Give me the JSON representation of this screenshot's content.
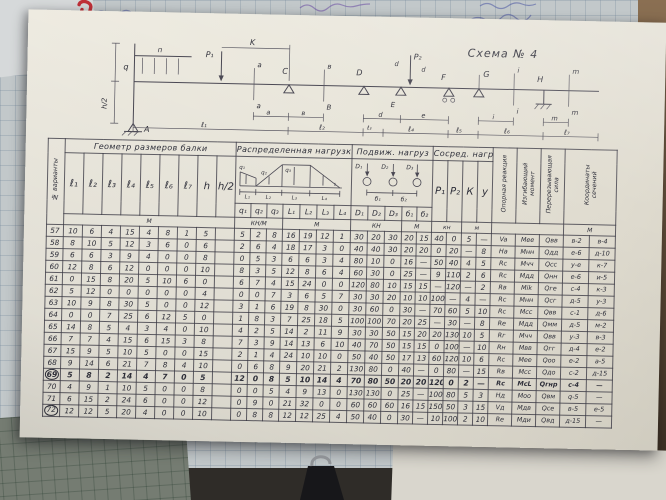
{
  "schematic": {
    "labels": {
      "title": "Схема № 4",
      "q": "q",
      "p": "п",
      "p1": "P₁",
      "p2": "P₂",
      "K": "K",
      "a": "a",
      "v": "в",
      "B": "B",
      "C": "C",
      "D": "D",
      "E": "E",
      "F": "F",
      "G": "G",
      "H": "H",
      "i": "i",
      "m": "m",
      "d": "d",
      "e": "e",
      "A": "А",
      "h2": "h/2",
      "l1": "ℓ₁",
      "l2": "ℓ₂",
      "l3": "ℓ₃",
      "l4": "ℓ₄",
      "l5": "ℓ₅",
      "l6": "ℓ₆",
      "l7": "ℓ₇"
    }
  },
  "table": {
    "corner_label": "№ варианты",
    "geometry": {
      "title": "Геометр размеров балки",
      "cols": [
        "ℓ₁",
        "ℓ₂",
        "ℓ₃",
        "ℓ₄",
        "ℓ₅",
        "ℓ₆",
        "ℓ₇",
        "h",
        "h/2"
      ]
    },
    "distributed": {
      "title": "Распределенная нагрузка",
      "cols": [
        "q₁",
        "q₂",
        "q₃",
        "L₁",
        "L₂",
        "L₃",
        "L₄"
      ]
    },
    "moving": {
      "title": "Подвиж. нагруз",
      "cols": [
        "D₁",
        "D₂",
        "D₃",
        "б₁",
        "б₂"
      ]
    },
    "concentrated": {
      "title": "Сосред. нагр",
      "cols": [
        "P₁",
        "P₂",
        "К",
        "у"
      ]
    },
    "results": {
      "rotated_headers": [
        "Опорная реакция",
        "Изгибающий момент",
        "Перерезывающая сила",
        "Координаты сечений"
      ]
    },
    "units": {
      "geometry": "М",
      "dist_q": "КН/М",
      "dist_l": "М",
      "move_d": "КН",
      "move_b": "М",
      "conc_p": "кн",
      "conc_k": "м",
      "coord": "М"
    },
    "rows": [
      {
        "n": "57",
        "mark": "",
        "cells": [
          "10",
          "6",
          "4",
          "15",
          "4",
          "8",
          "1",
          "5",
          "",
          "5",
          "2",
          "8",
          "16",
          "19",
          "12",
          "1",
          "30",
          "20",
          "30",
          "20",
          "15",
          "40",
          "0",
          "5",
          "—",
          "Va",
          "Мee",
          "Qвв",
          "в-2",
          "в-4"
        ]
      },
      {
        "n": "58",
        "mark": "",
        "cells": [
          "8",
          "10",
          "5",
          "12",
          "3",
          "6",
          "0",
          "6",
          "",
          "2",
          "6",
          "4",
          "18",
          "17",
          "3",
          "0",
          "40",
          "40",
          "30",
          "20",
          "20",
          "0",
          "20",
          "—",
          "8",
          "На",
          "Мнн",
          "Qдд",
          "е-6",
          "д-10"
        ]
      },
      {
        "n": "59",
        "mark": "",
        "cells": [
          "6",
          "6",
          "3",
          "9",
          "4",
          "0",
          "0",
          "8",
          "",
          "0",
          "5",
          "3",
          "6",
          "6",
          "3",
          "4",
          "80",
          "10",
          "0",
          "16",
          "—",
          "50",
          "40",
          "4",
          "5",
          "Rс",
          "Мчч",
          "Qсс",
          "у-е",
          "к-7"
        ]
      },
      {
        "n": "60",
        "mark": "",
        "cells": [
          "12",
          "8",
          "6",
          "12",
          "0",
          "0",
          "0",
          "10",
          "",
          "8",
          "3",
          "5",
          "12",
          "8",
          "6",
          "4",
          "60",
          "30",
          "0",
          "25",
          "—",
          "9",
          "110",
          "2",
          "6",
          "Rс",
          "Мдд",
          "Qнн",
          "е-6",
          "и-5"
        ]
      },
      {
        "n": "61",
        "mark": "",
        "cells": [
          "0",
          "15",
          "8",
          "20",
          "5",
          "10",
          "6",
          "0",
          "",
          "6",
          "7",
          "4",
          "15",
          "24",
          "0",
          "0",
          "120",
          "80",
          "10",
          "15",
          "15",
          "—",
          "120",
          "—",
          "2",
          "Rв",
          "Мik",
          "Qге",
          "с-4",
          "к-3"
        ]
      },
      {
        "n": "62",
        "mark": "",
        "cells": [
          "5",
          "12",
          "0",
          "0",
          "0",
          "0",
          "0",
          "4",
          "",
          "0",
          "0",
          "7",
          "3",
          "6",
          "5",
          "7",
          "30",
          "30",
          "20",
          "10",
          "10",
          "100",
          "—",
          "4",
          "—",
          "Rс",
          "Мнн",
          "Qсг",
          "д-5",
          "у-3"
        ]
      },
      {
        "n": "63",
        "mark": "",
        "cells": [
          "10",
          "9",
          "8",
          "30",
          "5",
          "0",
          "0",
          "12",
          "",
          "3",
          "1",
          "6",
          "19",
          "8",
          "30",
          "0",
          "30",
          "60",
          "0",
          "30",
          "—",
          "70",
          "60",
          "5",
          "10",
          "Rс",
          "Мсс",
          "Qвв",
          "с-1",
          "д-6"
        ]
      },
      {
        "n": "64",
        "mark": "",
        "cells": [
          "0",
          "0",
          "7",
          "25",
          "6",
          "12",
          "5",
          "0",
          "",
          "1",
          "8",
          "3",
          "7",
          "25",
          "18",
          "5",
          "100",
          "100",
          "70",
          "20",
          "25",
          "—",
          "30",
          "—",
          "8",
          "Rе",
          "Мдд",
          "Qмм",
          "д-5",
          "м-2"
        ]
      },
      {
        "n": "65",
        "mark": "",
        "cells": [
          "14",
          "8",
          "5",
          "4",
          "3",
          "4",
          "0",
          "10",
          "",
          "4",
          "2",
          "5",
          "14",
          "2",
          "11",
          "9",
          "30",
          "30",
          "50",
          "15",
          "20",
          "20",
          "130",
          "10",
          "5",
          "Rг",
          "Мчч",
          "Qвв",
          "у-3",
          "в-3"
        ]
      },
      {
        "n": "66",
        "mark": "",
        "cells": [
          "7",
          "7",
          "4",
          "15",
          "6",
          "15",
          "3",
          "8",
          "",
          "7",
          "3",
          "9",
          "14",
          "13",
          "6",
          "10",
          "40",
          "70",
          "50",
          "15",
          "15",
          "0",
          "100",
          "—",
          "10",
          "Rн",
          "Мвв",
          "Qгг",
          "д-4",
          "е-2"
        ]
      },
      {
        "n": "67",
        "mark": "",
        "cells": [
          "15",
          "9",
          "5",
          "10",
          "5",
          "0",
          "0",
          "15",
          "",
          "2",
          "1",
          "4",
          "24",
          "10",
          "10",
          "0",
          "50",
          "40",
          "50",
          "17",
          "13",
          "60",
          "120",
          "10",
          "6",
          "Rс",
          "Мее",
          "Qоо",
          "е-2",
          "а-5"
        ]
      },
      {
        "n": "68",
        "mark": "",
        "cells": [
          "9",
          "14",
          "6",
          "21",
          "7",
          "8",
          "4",
          "10",
          "",
          "0",
          "6",
          "8",
          "9",
          "20",
          "21",
          "2",
          "130",
          "80",
          "0",
          "40",
          "—",
          "0",
          "80",
          "—",
          "15",
          "Rв",
          "Мсс",
          "Qдо",
          "с-2",
          "д-15"
        ]
      },
      {
        "n": "69",
        "mark": "bold-circle",
        "cells": [
          "5",
          "8",
          "2",
          "14",
          "4",
          "7",
          "0",
          "5",
          "",
          "12",
          "0",
          "8",
          "5",
          "10",
          "14",
          "4",
          "70",
          "80",
          "50",
          "20",
          "20",
          "120",
          "0",
          "2",
          "—",
          "Rс",
          "МсL",
          "Qгнр",
          "с-4",
          "—"
        ]
      },
      {
        "n": "70",
        "mark": "",
        "cells": [
          "4",
          "9",
          "1",
          "10",
          "5",
          "0",
          "0",
          "8",
          "",
          "0",
          "0",
          "5",
          "4",
          "9",
          "13",
          "0",
          "130",
          "130",
          "0",
          "25",
          "—",
          "100",
          "80",
          "5",
          "3",
          "Нд",
          "Моо",
          "Qвм",
          "q-5",
          "—"
        ]
      },
      {
        "n": "71",
        "mark": "",
        "cells": [
          "6",
          "15",
          "2",
          "24",
          "6",
          "0",
          "0",
          "12",
          "",
          "0",
          "9",
          "0",
          "21",
          "32",
          "0",
          "0",
          "60",
          "60",
          "60",
          "16",
          "15",
          "150",
          "50",
          "3",
          "15",
          "Vд",
          "Мдв",
          "Qсе",
          "в-5",
          "е-5"
        ]
      },
      {
        "n": "72",
        "mark": "circle",
        "cells": [
          "12",
          "12",
          "5",
          "20",
          "4",
          "0",
          "0",
          "10",
          "",
          "0",
          "8",
          "8",
          "12",
          "12",
          "25",
          "4",
          "50",
          "40",
          "0",
          "30",
          "—",
          "10",
          "100",
          "2",
          "10",
          "Rе",
          "Мди",
          "Qвд",
          "д-15",
          "—"
        ]
      }
    ]
  }
}
